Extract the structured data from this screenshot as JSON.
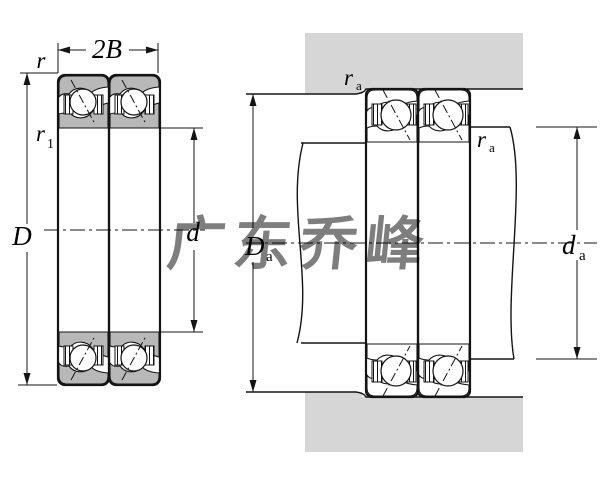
{
  "diagram_title": "duplex-angular-contact-bearing-dimension-and-mounting-drawing",
  "watermark": {
    "text": "广东乔峰"
  },
  "colors": {
    "ring_fill": "#b8b8b8",
    "housing_fill": "#d6d6d6",
    "watermark_fill": "#9191cf"
  },
  "left_view": {
    "labels": {
      "width": "2B",
      "outer_chamfer": "r",
      "inner_chamfer_base": "r",
      "inner_chamfer_sub": "1",
      "outer_diameter": "D",
      "bore_diameter": "d"
    }
  },
  "right_view": {
    "labels": {
      "housing_fillet_base": "r",
      "housing_fillet_sub": "a",
      "shaft_fillet_base": "r",
      "shaft_fillet_sub": "a",
      "housing_shoulder_base": "D",
      "housing_shoulder_sub": "a",
      "shaft_shoulder_base": "d",
      "shaft_shoulder_sub": "a"
    }
  }
}
